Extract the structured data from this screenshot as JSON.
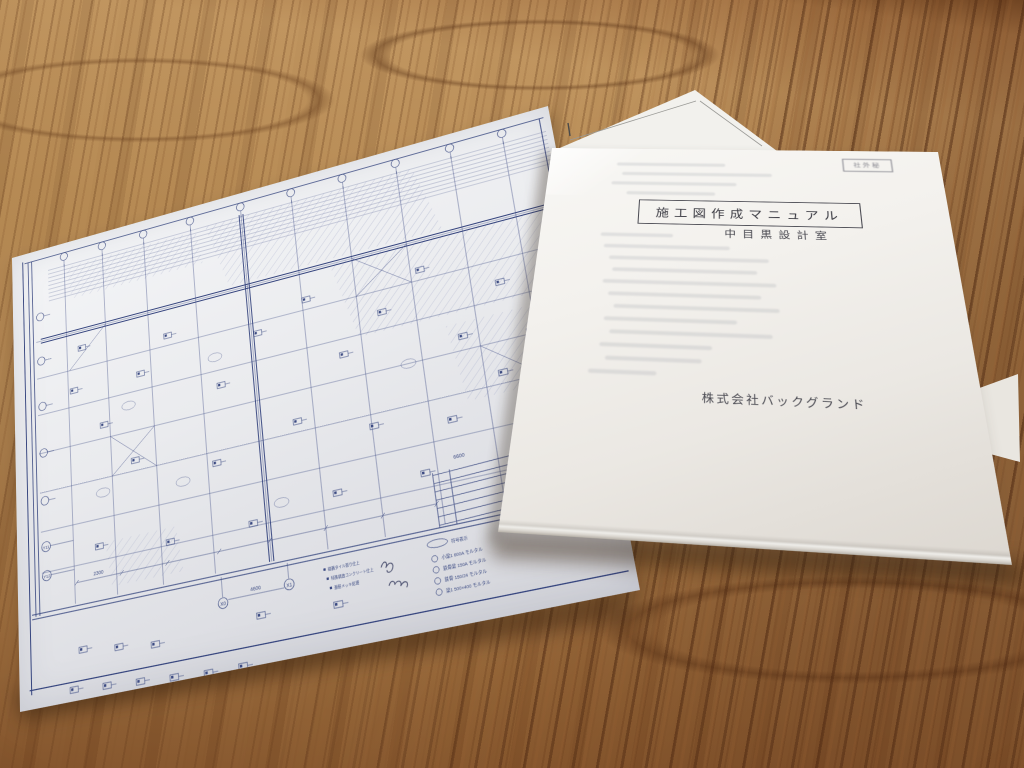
{
  "cover": {
    "title": "施工図作成マニュアル",
    "subtitle": "中目黒設計室",
    "company": "株式会社バックグランド",
    "stamp": "社外秘"
  },
  "blueprint": {
    "axis_labels": {
      "x0": "X0",
      "x1": "X1",
      "y11": "Y11",
      "y12": "Y12"
    },
    "dims": {
      "d1": "4600",
      "d2": "2300",
      "d3": "6600"
    },
    "legend_title": "符号表示",
    "legend": [
      "小梁1 600A モルタル",
      "鉄骨梁 150A モルタル",
      "鉄骨 150/24 モルタル",
      "梁1 500×400 モルタル"
    ],
    "notes": [
      "磁器タイル張り仕上",
      "特殊構造コンクリート仕上",
      "亜鉛メッキ処理"
    ]
  },
  "colors": {
    "ink": "#3b4a82",
    "wood": "#b5864e"
  }
}
